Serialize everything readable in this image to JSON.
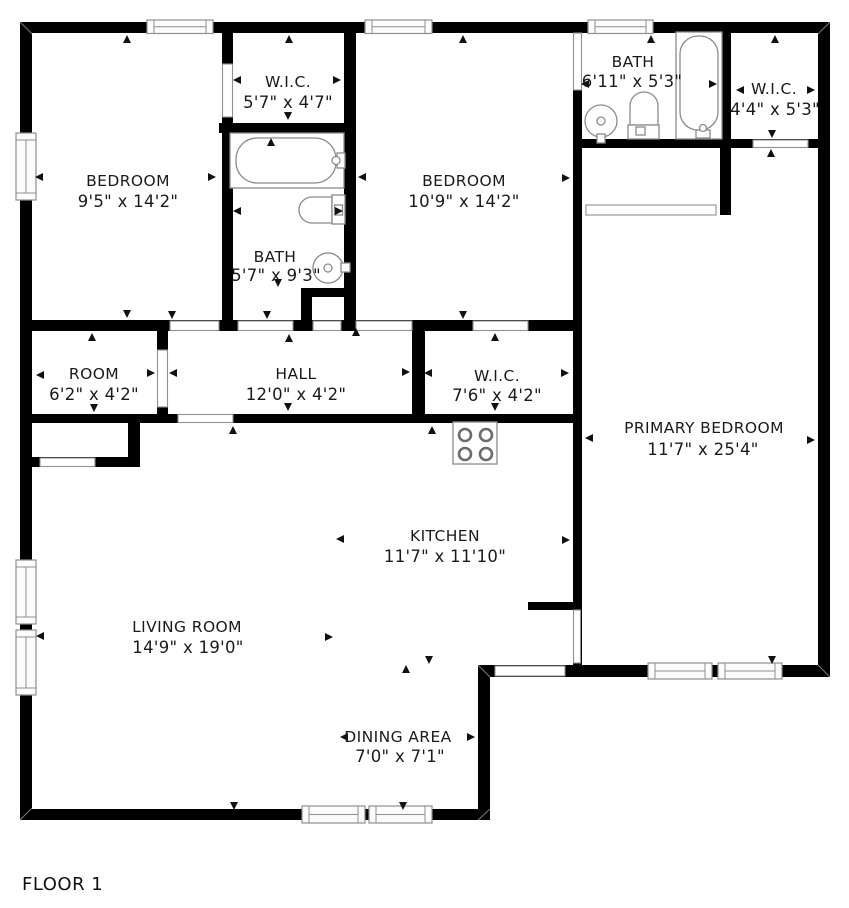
{
  "floor_label": "FLOOR 1",
  "colors": {
    "wall": "#000000",
    "text": "#1a1a1a",
    "opening_outline": "#8f8f8f",
    "fixture_outline": "#8a8a8a",
    "background": "#ffffff"
  },
  "rooms": [
    {
      "name": "BEDROOM",
      "dims": "9'5\" x 14'2\""
    },
    {
      "name": "W.I.C.",
      "dims": "5'7\" x 4'7\""
    },
    {
      "name": "BATH",
      "dims": "5'7\" x 9'3\""
    },
    {
      "name": "BEDROOM",
      "dims": "10'9\" x 14'2\""
    },
    {
      "name": "BATH",
      "dims": "6'11\" x 5'3\""
    },
    {
      "name": "W.I.C.",
      "dims": "4'4\" x 5'3\""
    },
    {
      "name": "ROOM",
      "dims": "6'2\" x 4'2\""
    },
    {
      "name": "HALL",
      "dims": "12'0\" x 4'2\""
    },
    {
      "name": "W.I.C.",
      "dims": "7'6\" x 4'2\""
    },
    {
      "name": "PRIMARY BEDROOM",
      "dims": "11'7\" x 25'4\""
    },
    {
      "name": "KITCHEN",
      "dims": "11'7\" x 11'10\""
    },
    {
      "name": "LIVING ROOM",
      "dims": "14'9\" x 19'0\""
    },
    {
      "name": "DINING AREA",
      "dims": "7'0\" x 7'1\""
    }
  ]
}
